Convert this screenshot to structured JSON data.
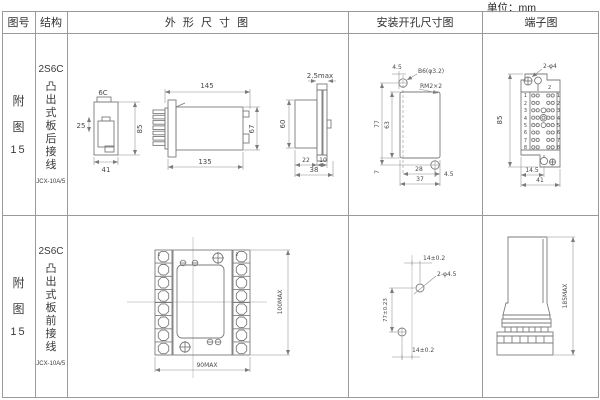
{
  "page": {
    "unit": "单位：mm"
  },
  "headers": {
    "fig": "图号",
    "structure": "结构",
    "outline": "外 形 尺 寸 图",
    "mounting": "安装开孔尺寸图",
    "terminal": "端子图"
  },
  "rows": [
    {
      "fig_line1": "附",
      "fig_line2": "图",
      "fig_num": "15",
      "model": "2S6C",
      "mount_type": "凸出式板后接线",
      "relay_type": "JCX-10A/5",
      "outline": {
        "label_6c": "6C",
        "d25": "25",
        "d85": "85",
        "d41": "41",
        "d145": "145",
        "d135": "135",
        "d67": "67",
        "d25max": "2.5max",
        "d60": "60",
        "d22": "22",
        "d10": "10",
        "d38": "38"
      },
      "mounting": {
        "d45_top": "4.5",
        "hole_label": "B6(φ3.2)",
        "thread_label": "RM2×2",
        "d77": "77",
        "d63": "63",
        "d7": "7",
        "d28": "28",
        "d37": "37",
        "d45_right": "4.5"
      },
      "terminal": {
        "hole_label": "2-φ4",
        "screw_label": "2",
        "left_pins": [
          "1",
          "2",
          "3",
          "4",
          "5",
          "6",
          "7",
          "8"
        ],
        "right_pins": [
          "1",
          "2",
          "3",
          "4",
          "5",
          "6",
          "7",
          "8"
        ],
        "d85": "85",
        "d14_5": "14.5",
        "d41": "41"
      }
    },
    {
      "fig_line1": "附",
      "fig_line2": "图",
      "fig_num": "15",
      "model": "2S6C",
      "mount_type": "凸出式板前接线",
      "relay_type": "JCX-10A/5",
      "outline": {
        "d90": "90MAX",
        "d100": "100MAX",
        "corner1": "1",
        "corner2": "2"
      },
      "mounting": {
        "d14_top": "14±0.2",
        "hole_label": "2-φ4.5",
        "d77": "77±0.23",
        "d14_bottom": "14±0.2"
      },
      "terminal": {
        "d185": "185MAX"
      }
    }
  ]
}
